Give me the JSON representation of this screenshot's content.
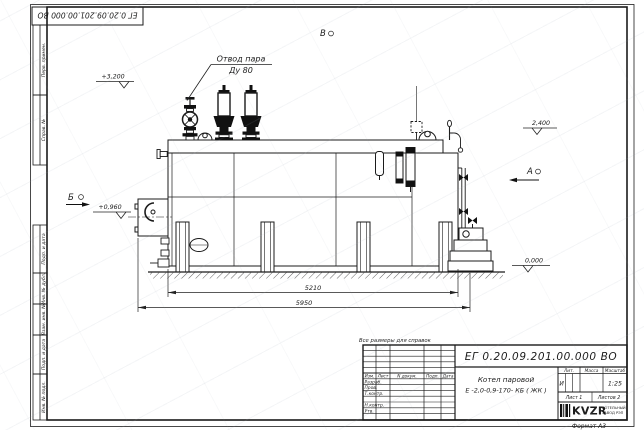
{
  "page": {
    "background": "#ffffff",
    "line_color": "#1b1b1b"
  },
  "frame": {
    "corner_doc_number": "ЕГ 0.20.09.201.00.000 ВО",
    "format_label": "Формат А3",
    "margin_stamps": [
      "Перв. примен.",
      "Справ. №",
      "Подп. и дата",
      "Инв. № дубл.",
      "Взам. инв. №",
      "Подп. и дата",
      "Инв. № подл."
    ]
  },
  "drawing": {
    "steam_outlet_label_line1": "Отвод пара",
    "steam_outlet_label_line2": "Ду 80",
    "elevation_top": "+3,200",
    "elevation_drum": "2,400",
    "elevation_burner": "+0,960",
    "elevation_ground": "0,000",
    "view_a": "А",
    "view_b": "Б",
    "view_v": "В",
    "dim_inner": "5210",
    "dim_overall": "5950"
  },
  "title_block": {
    "note": "Все размеры для справок",
    "doc_number": "ЕГ 0.20.09.201.00.000 ВО",
    "name_line1": "Котел паровой",
    "name_line2": "Е -2,0-0,9-170- КБ ( ЖК )",
    "col_izm": "Изм.",
    "col_list": "Лист",
    "col_doc": "N докум.",
    "col_podp": "Подп.",
    "col_data": "Дата",
    "row_razrab": "Разраб.",
    "row_prov": "Пров.",
    "row_tkontr": "Т.контр.",
    "row_nkontr": "Н.контр.",
    "row_utv": "Утв.",
    "lit_header": "Лит.",
    "mass_header": "Масса",
    "scale_header": "Масштаб",
    "lit_value": "И",
    "scale_value": "1:25",
    "sheet_label": "Лист 1",
    "sheets_label": "Листов 2",
    "logo_text": "KVZR",
    "company_line1": "КОТЕЛЬНЫЙ",
    "company_line2": "ЗАВОД РЭП"
  }
}
